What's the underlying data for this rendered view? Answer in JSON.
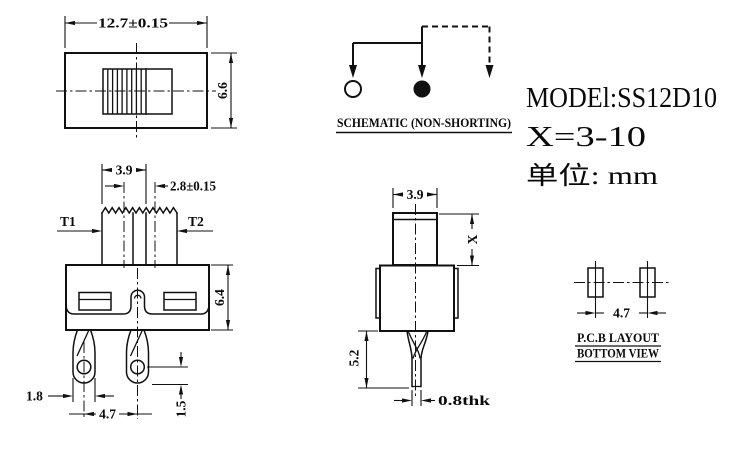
{
  "colors": {
    "line": "#111111",
    "background": "#ffffff"
  },
  "title_block": {
    "model": "MODEl:SS12D10",
    "x_range": "X=3-10",
    "units": "单位: mm"
  },
  "top_view": {
    "dim_width": "12.7±0.15",
    "dim_height": "6.6"
  },
  "front_view": {
    "dim_knob_width": "3.9",
    "dim_travel": "2.8±0.15",
    "terminal_left": "T1",
    "terminal_right": "T2",
    "dim_body_height": "6.4",
    "dim_leg_width": "1.8",
    "dim_leg_pitch": "4.7",
    "dim_hole_to_tip": "1.5"
  },
  "side_view": {
    "dim_knob_width": "3.9",
    "dim_knob_height": "X",
    "dim_leg_length": "5.2",
    "dim_leg_thickness": "0.8thk"
  },
  "schematic": {
    "caption": "SCHEMATIC (NON-SHORTING)"
  },
  "pcb_layout": {
    "caption_line1": "P.C.B LAYOUT",
    "caption_line2": "BOTTOM VIEW",
    "dim_pad_pitch": "4.7"
  }
}
